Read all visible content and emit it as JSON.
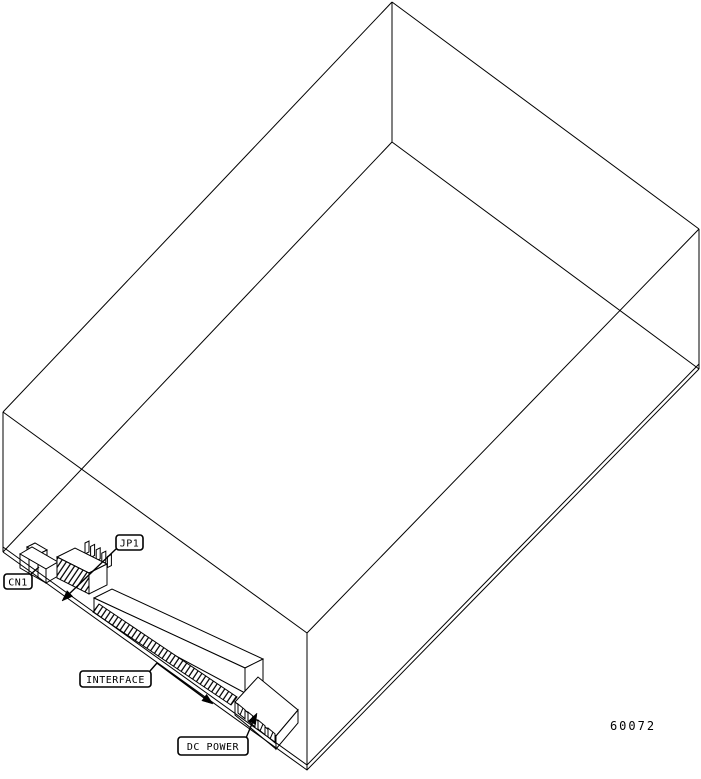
{
  "figure": {
    "number": "60072",
    "background_color": "#ffffff",
    "line_color": "#000000"
  },
  "labels": {
    "cn1": "CN1",
    "jp1": "JP1",
    "interface": "INTERFACE",
    "dc_power": "DC POWER"
  }
}
